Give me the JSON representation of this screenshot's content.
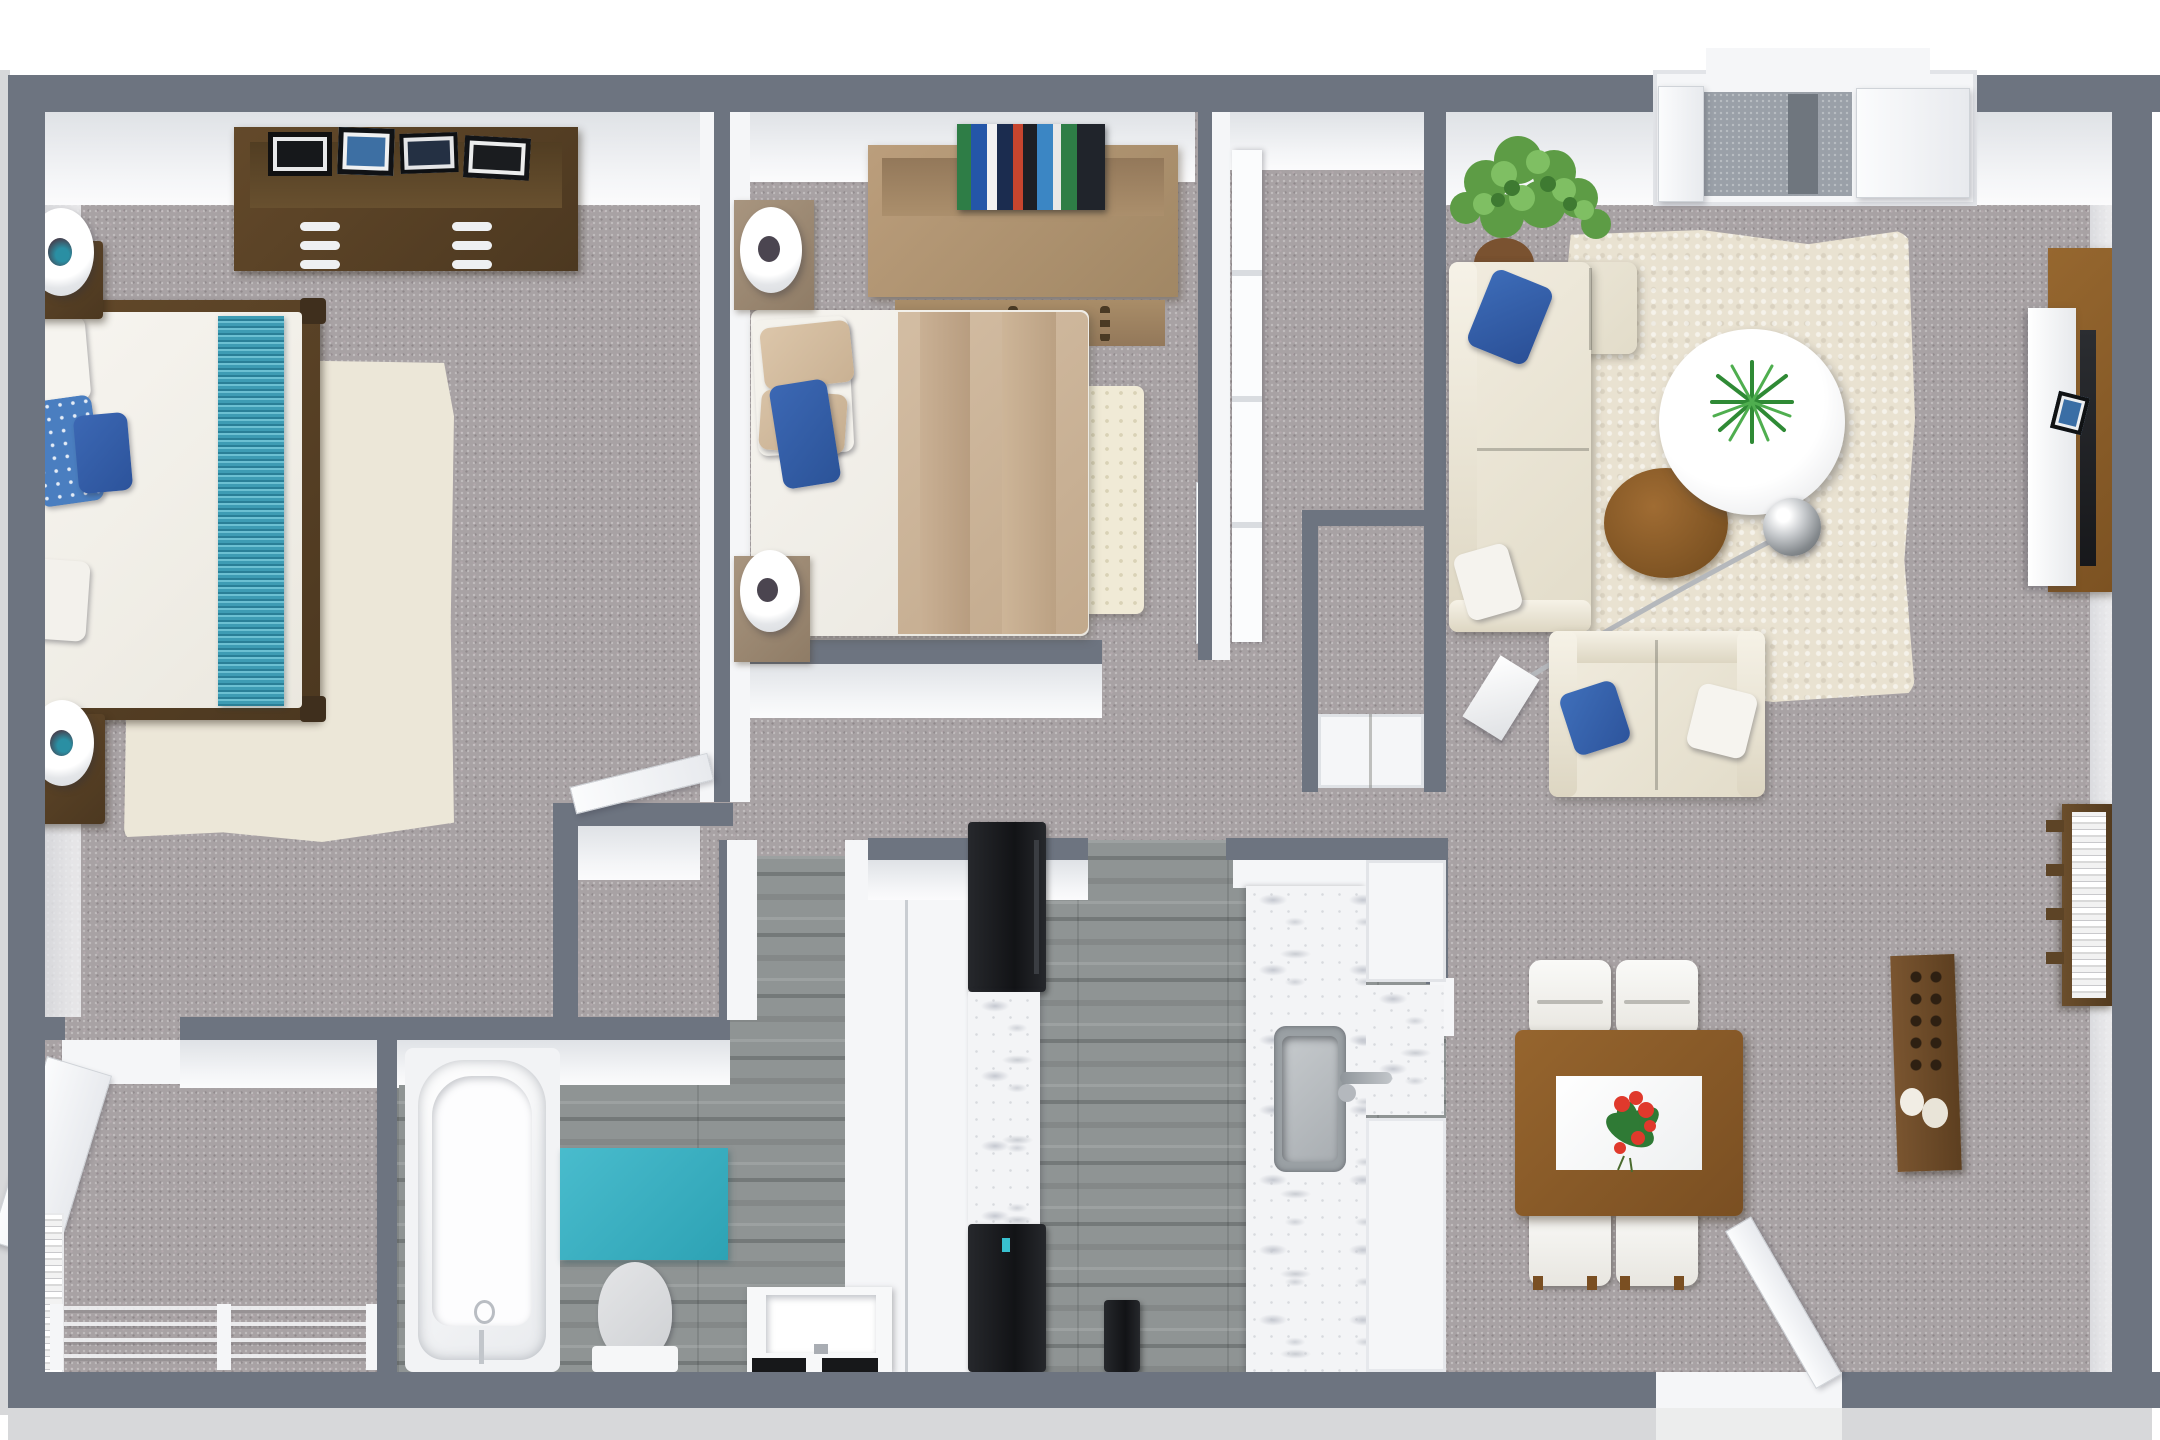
{
  "scene": {
    "type": "3d-floor-plan-render",
    "description": "Top-down 3D rendered floor plan of a two-bedroom, one-bathroom apartment with galley kitchen, combined living and dining area, hallway, walk-in closet and entry door at top right.",
    "rooms": [
      {
        "id": "master-bedroom",
        "area": "top-left",
        "furniture": [
          "dresser with picture frames",
          "bed with teal runner and blue floral pillows",
          "two nightstands with round white lamps",
          "cream area rug"
        ]
      },
      {
        "id": "bedroom-2",
        "area": "top-middle",
        "furniture": [
          "headboard bookshelf with books",
          "bed with tan blanket and blue pillow",
          "two nightstands with round white lamps",
          "cream dotted rug",
          "sliding-door closet"
        ]
      },
      {
        "id": "living-room",
        "area": "top-right",
        "furniture": [
          "corner plant",
          "cream sectional sofa with blue pillow",
          "round white coffee table with plant",
          "wood side table",
          "arc floor lamp with chrome shade",
          "loveseat with blue and white pillows",
          "TV wall panel with console and picture frame",
          "ladder bookshelf"
        ]
      },
      {
        "id": "dining-area",
        "area": "bottom-right",
        "furniture": [
          "wood dining table with white runner and red flower centerpiece",
          "four white chairs",
          "tall display cabinet"
        ]
      },
      {
        "id": "kitchen",
        "area": "bottom-middle",
        "furniture": [
          "refrigerator",
          "stove",
          "marble counters",
          "stainless sink with faucet",
          "dishwasher",
          "cabinets"
        ]
      },
      {
        "id": "bathroom",
        "area": "bottom-left-middle",
        "furniture": [
          "bathtub",
          "teal bath mat",
          "toilet",
          "vanity sink"
        ]
      },
      {
        "id": "walk-in-closet",
        "area": "bottom-left",
        "furniture": [
          "closet rods with posts",
          "side shelving unit"
        ]
      },
      {
        "id": "hallway",
        "area": "center",
        "furniture": [
          "hall closet with double doors"
        ]
      }
    ],
    "doors": [
      "front entry door top-right with doormat",
      "master bedroom door",
      "bedroom-2 door",
      "walk-in closet door",
      "hall closet double doors",
      "back door bottom-right"
    ]
  },
  "colors": {
    "wall": "#6d7480",
    "slab": "#d7d8da",
    "carpet": "#a8a2a4",
    "woodFloor": "#8f9494",
    "marble": "#f3f4f6",
    "cream": "#ece7d8",
    "rugCream": "#f0ead6",
    "teal": "#3cb0c2",
    "tealRunner": "#3e9cb4",
    "blue": "#3c68b4",
    "floralBlue": "#4a7ec0",
    "blanketTan": "#cbb097",
    "darkWood": "#5a4427",
    "midWood": "#8a5a28",
    "tanWood": "#b29573",
    "appliance": "#1d1f22",
    "steel": "#9aa0a4",
    "flowerRed": "#d93a2e",
    "leafGreen": "#2f7a35"
  }
}
